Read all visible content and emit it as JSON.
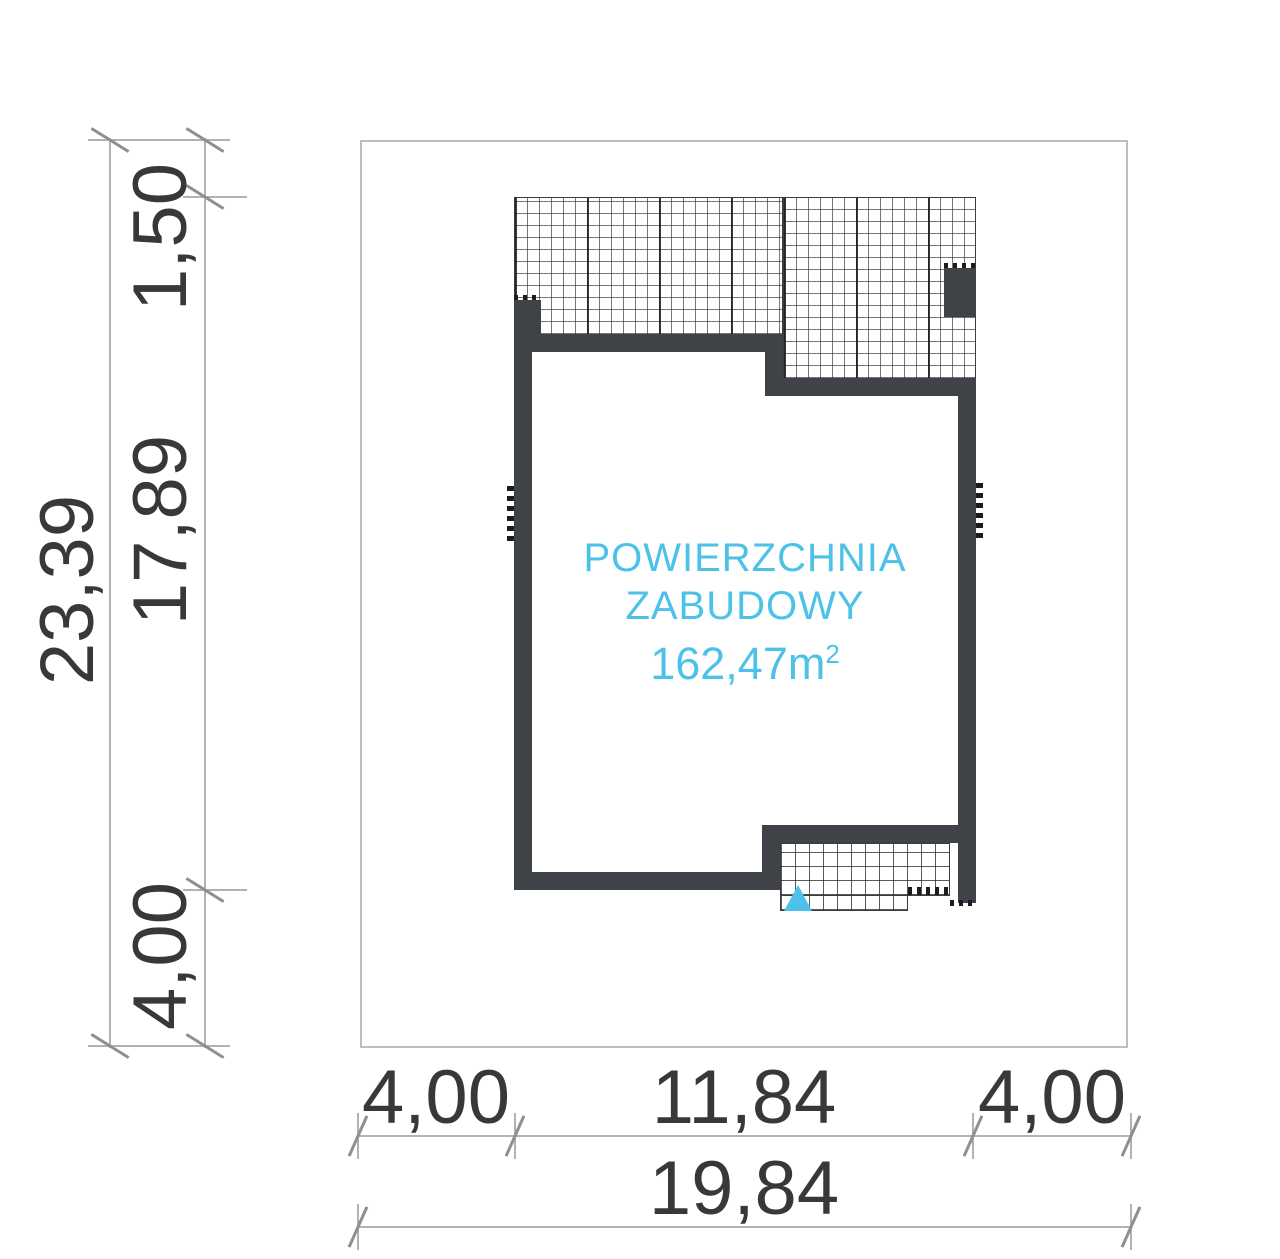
{
  "title": "Building footprint site plan",
  "area_label": {
    "line1": "POWIERZCHNIA",
    "line2": "ZABUDOWY",
    "value": "162,47m",
    "value_sup": "2"
  },
  "dimensions": {
    "left_total": "23,39",
    "left_top": "1,50",
    "left_middle": "17,89",
    "left_bottom": "4,00",
    "bottom_left": "4,00",
    "bottom_center": "11,84",
    "bottom_right": "4,00",
    "bottom_total": "19,84"
  },
  "colors": {
    "wall": "#3f4347",
    "accent_cyan": "#4cc2e9",
    "dim_line": "#b2b2b2",
    "dim_text": "#383838",
    "hatch_line": "#3c3c3c",
    "site_border": "#bcbec0"
  }
}
